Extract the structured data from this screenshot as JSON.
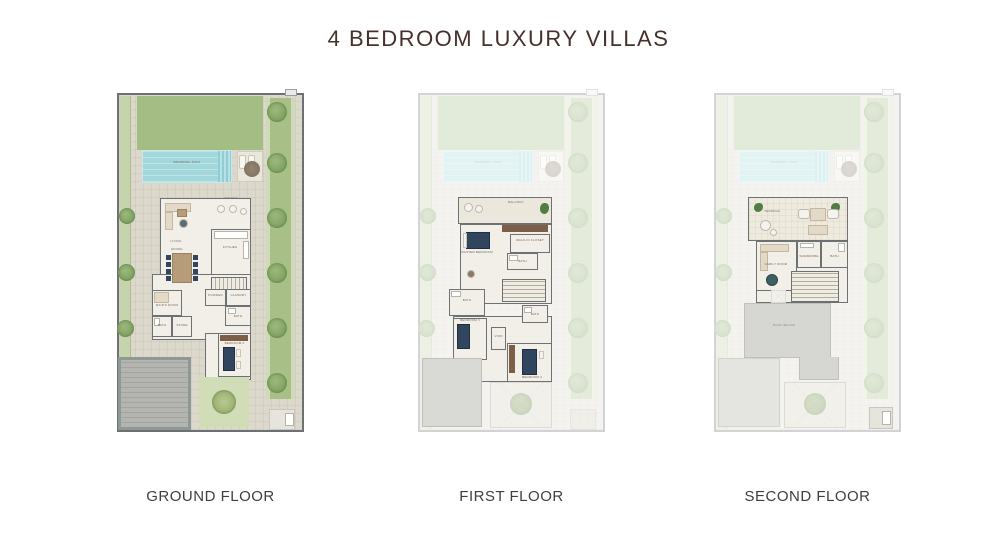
{
  "page": {
    "title": "4 BEDROOM LUXURY VILLAS"
  },
  "colors": {
    "title_text": "#46302b",
    "caption_text": "#3f3f3f",
    "lawn_green": "#a3bd85",
    "pool_teal": "#a2d8dc",
    "paving": "#ddd8cc",
    "wall_grey": "#6e7173",
    "interior_floor": "#f2efe8",
    "furniture_navy": "#32455f",
    "wood_brown": "#b69c79",
    "roof_grey": "#d6d7d3"
  },
  "site": {
    "pool_label": "SWIMMING POOL"
  },
  "plans": [
    {
      "caption": "GROUND FLOOR",
      "rooms": {
        "sitout": "SIT OUT",
        "living": "LIVING",
        "dining": "DINING",
        "kitchen": "KITCHEN",
        "powder": "POWDER",
        "laundry": "LAUNDRY",
        "maid": "MAID'S ROOM",
        "bath": "BATH",
        "store": "STORE",
        "bath2": "BATH",
        "bedroom": "BEDROOM 2"
      }
    },
    {
      "caption": "FIRST FLOOR",
      "rooms": {
        "balcony": "BALCONY",
        "master": "MASTER BEDROOM",
        "closet": "WALK-IN CLOSET",
        "bath": "BATH",
        "laundry": "BATH",
        "void": "VOID",
        "bedroom2": "BEDROOM 3",
        "bath3": "BATH",
        "bedroom3": "BEDROOM 4"
      }
    },
    {
      "caption": "SECOND FLOOR",
      "rooms": {
        "terrace": "TERRACE",
        "family": "FAMILY ROOM",
        "wardrobe": "WARDROBE",
        "bath": "BATH",
        "roof": "ROOF BELOW"
      }
    }
  ]
}
